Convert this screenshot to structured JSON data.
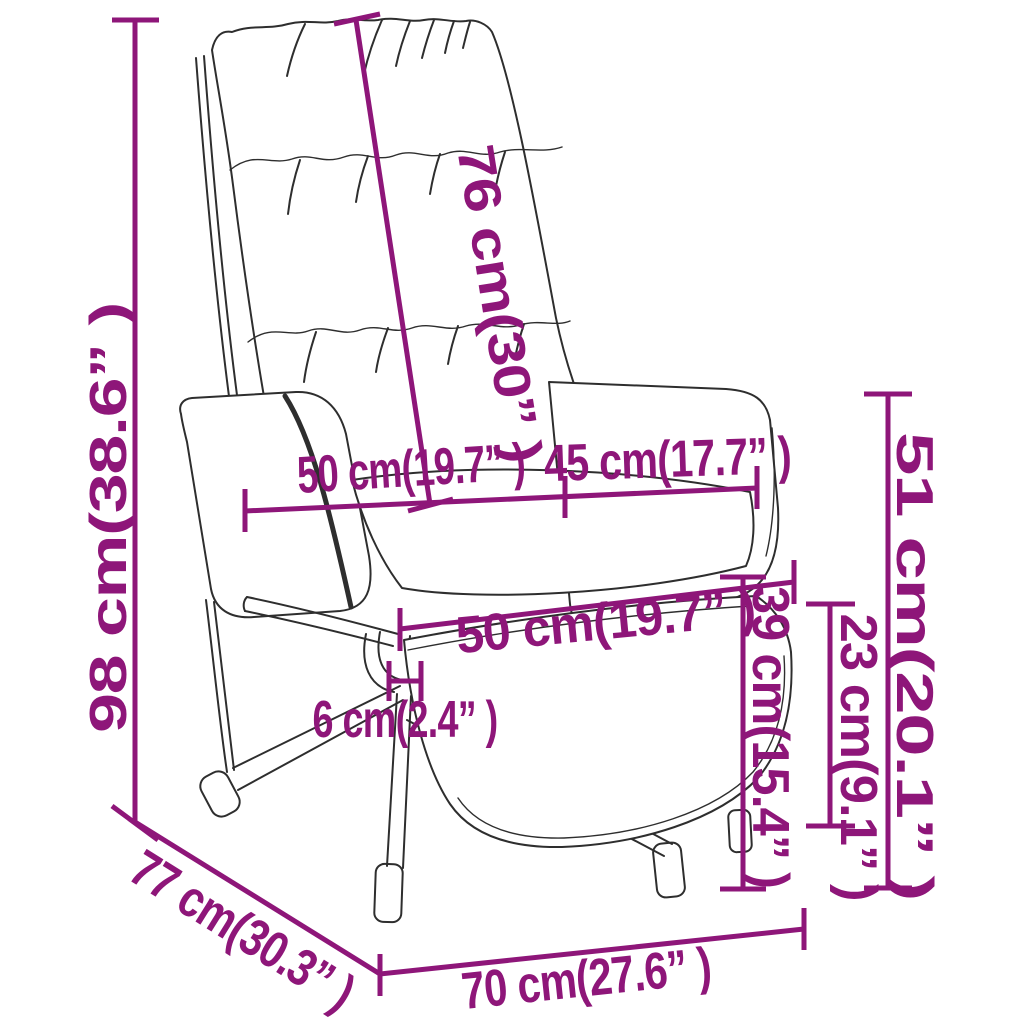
{
  "diagram": {
    "subject": "relax-chair-with-footstool",
    "colors": {
      "dimension": "#8E1679",
      "outline": "#2E2E2E",
      "background": "#FFFFFF"
    }
  },
  "measurements": [
    {
      "id": "total-height",
      "cm": 98,
      "inches": "38.6",
      "label": "98 cm(38.6” )"
    },
    {
      "id": "backrest-length",
      "cm": 76,
      "inches": "30",
      "label": "76 cm(30” )"
    },
    {
      "id": "seat-width",
      "cm": 50,
      "inches": "19.7",
      "label": "50 cm(19.7” )"
    },
    {
      "id": "armrest-depth",
      "cm": 45,
      "inches": "17.7",
      "label": "45 cm(17.7” )"
    },
    {
      "id": "footstool-width",
      "cm": 50,
      "inches": "19.7",
      "label": "50 cm(19.7” )"
    },
    {
      "id": "footstool-thickness",
      "cm": 6,
      "inches": "2.4",
      "label": "6 cm(2.4” )"
    },
    {
      "id": "footstool-height",
      "cm": 39,
      "inches": "15.4",
      "label": "39 cm(15.4” )"
    },
    {
      "id": "clearance-height",
      "cm": 23,
      "inches": "9.1",
      "label": "23 cm(9.1” )"
    },
    {
      "id": "seat-height",
      "cm": 51,
      "inches": "20.1",
      "label": "51 cm(20.1” )"
    },
    {
      "id": "total-depth",
      "cm": 77,
      "inches": "30.3",
      "label": "77 cm(30.3” )"
    },
    {
      "id": "base-width",
      "cm": 70,
      "inches": "27.6",
      "label": "70 cm(27.6” )"
    }
  ]
}
